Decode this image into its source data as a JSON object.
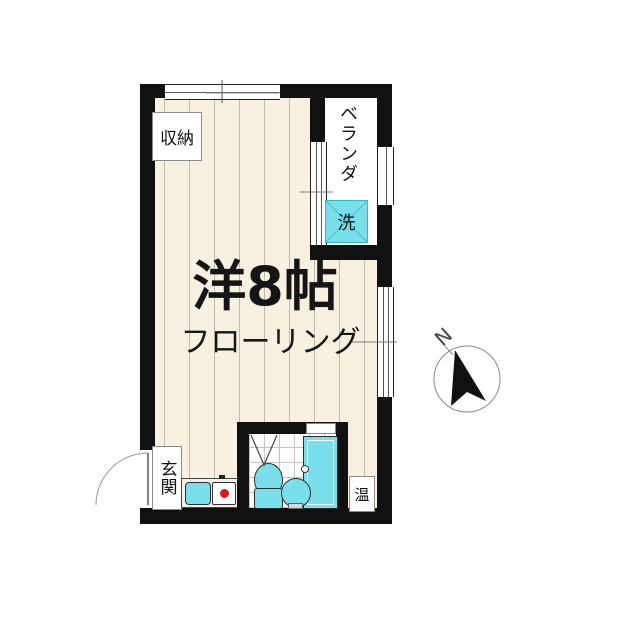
{
  "plan": {
    "room_label": "洋8帖",
    "room_sublabel": "フローリング",
    "storage": "収納",
    "veranda": "ベランダ",
    "washer": "洗",
    "entrance": "玄関",
    "water_heater": "温",
    "compass_north": "N"
  },
  "colors": {
    "wall": "#111111",
    "floor": "#f9f1df",
    "plank_line": "#c2b9a6",
    "fixture_cyan": "#79e0eb",
    "stove_burner_red": "#dd1418",
    "bath_tile_line": "#c4c4c4"
  }
}
